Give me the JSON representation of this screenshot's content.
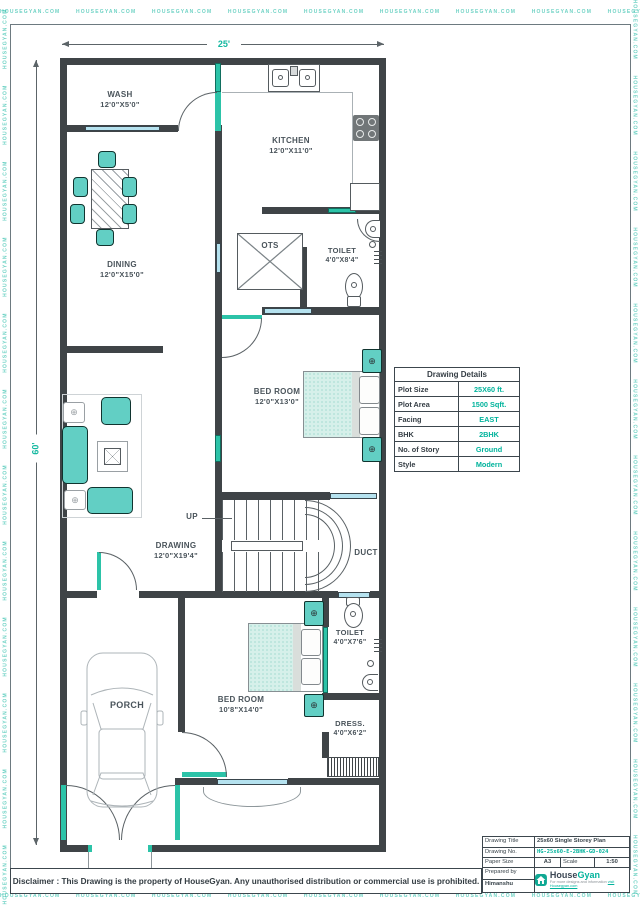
{
  "watermark": {
    "text": "HOUSEGYAN.COM",
    "strip": "HOUSEGYAN.COM      HOUSEGYAN.COM      HOUSEGYAN.COM      HOUSEGYAN.COM      HOUSEGYAN.COM      HOUSEGYAN.COM      HOUSEGYAN.COM      HOUSEGYAN.COM      HOUSEGYAN.COM      HOUSEGYAN.COM      HOUSEGYAN.COM      HOUSEGYAN.COM      HOUSEGYAN.COM      HOUSEGYAN.COM      HOUSEGYAN.COM      HOUSEGYAN.COM      HOUSEGYAN.COM      HOUSEGYAN.COM"
  },
  "dimensions": {
    "width": "25'",
    "height": "60'"
  },
  "rooms": {
    "wash": {
      "name": "WASH",
      "size": "12'0\"X5'0\""
    },
    "kitchen": {
      "name": "KITCHEN",
      "size": "12'0\"X11'0\""
    },
    "dining": {
      "name": "DINING",
      "size": "12'0\"X15'0\""
    },
    "ots": {
      "name": "OTS"
    },
    "toilet1": {
      "name": "TOILET",
      "size": "4'0\"X8'4\""
    },
    "bedroom1": {
      "name": "BED ROOM",
      "size": "12'0\"X13'0\""
    },
    "drawing": {
      "name": "DRAWING",
      "size": "12'0\"X19'4\""
    },
    "duct": {
      "name": "DUCT"
    },
    "up": {
      "name": "UP"
    },
    "toilet2": {
      "name": "TOILET",
      "size": "4'0\"X7'6\""
    },
    "bedroom2": {
      "name": "BED ROOM",
      "size": "10'8\"X14'0\""
    },
    "dress": {
      "name": "DRESS.",
      "size": "4'0\"X6'2\""
    },
    "porch": {
      "name": "PORCH"
    }
  },
  "details_table": {
    "title": "Drawing Details",
    "rows": [
      {
        "label": "Plot Size",
        "value": "25X60 ft."
      },
      {
        "label": "Plot Area",
        "value": "1500 Sqft."
      },
      {
        "label": "Facing",
        "value": "EAST"
      },
      {
        "label": "BHK",
        "value": "2BHK"
      },
      {
        "label": "No. of Story",
        "value": "Ground"
      },
      {
        "label": "Style",
        "value": "Modern"
      }
    ]
  },
  "title_block": {
    "drawing_title_label": "Drawing Title",
    "drawing_title": "25x60 Single Storey Plan",
    "drawing_no_label": "Drawing No.",
    "drawing_no": "HG-25x60-E-2BHK-GD-024",
    "paper_size_label": "Paper Size",
    "paper_size": "A3",
    "scale_label": "Scale",
    "scale": "1:50",
    "prepared_by_label": "Prepared by",
    "prepared_by": "Himanshu"
  },
  "logo": {
    "brand_primary": "House",
    "brand_secondary": "Gyan",
    "tagline_line1": "For more designs and information",
    "tagline_line2": "visit Housegyan.com"
  },
  "disclaimer": "Disclaimer : This Drawing is the property of HouseGyan. Any unauthorised distribution or commercial use is prohibited.",
  "icons": {
    "nightstand_cross": "⊕",
    "side_table_cross": "⊕"
  },
  "colors": {
    "accent_teal": "#14b8a0",
    "furniture_teal": "#62cfc4",
    "window_blue": "#b5e2ef",
    "wall": "#3f4447",
    "value_teal": "#00b39c"
  }
}
